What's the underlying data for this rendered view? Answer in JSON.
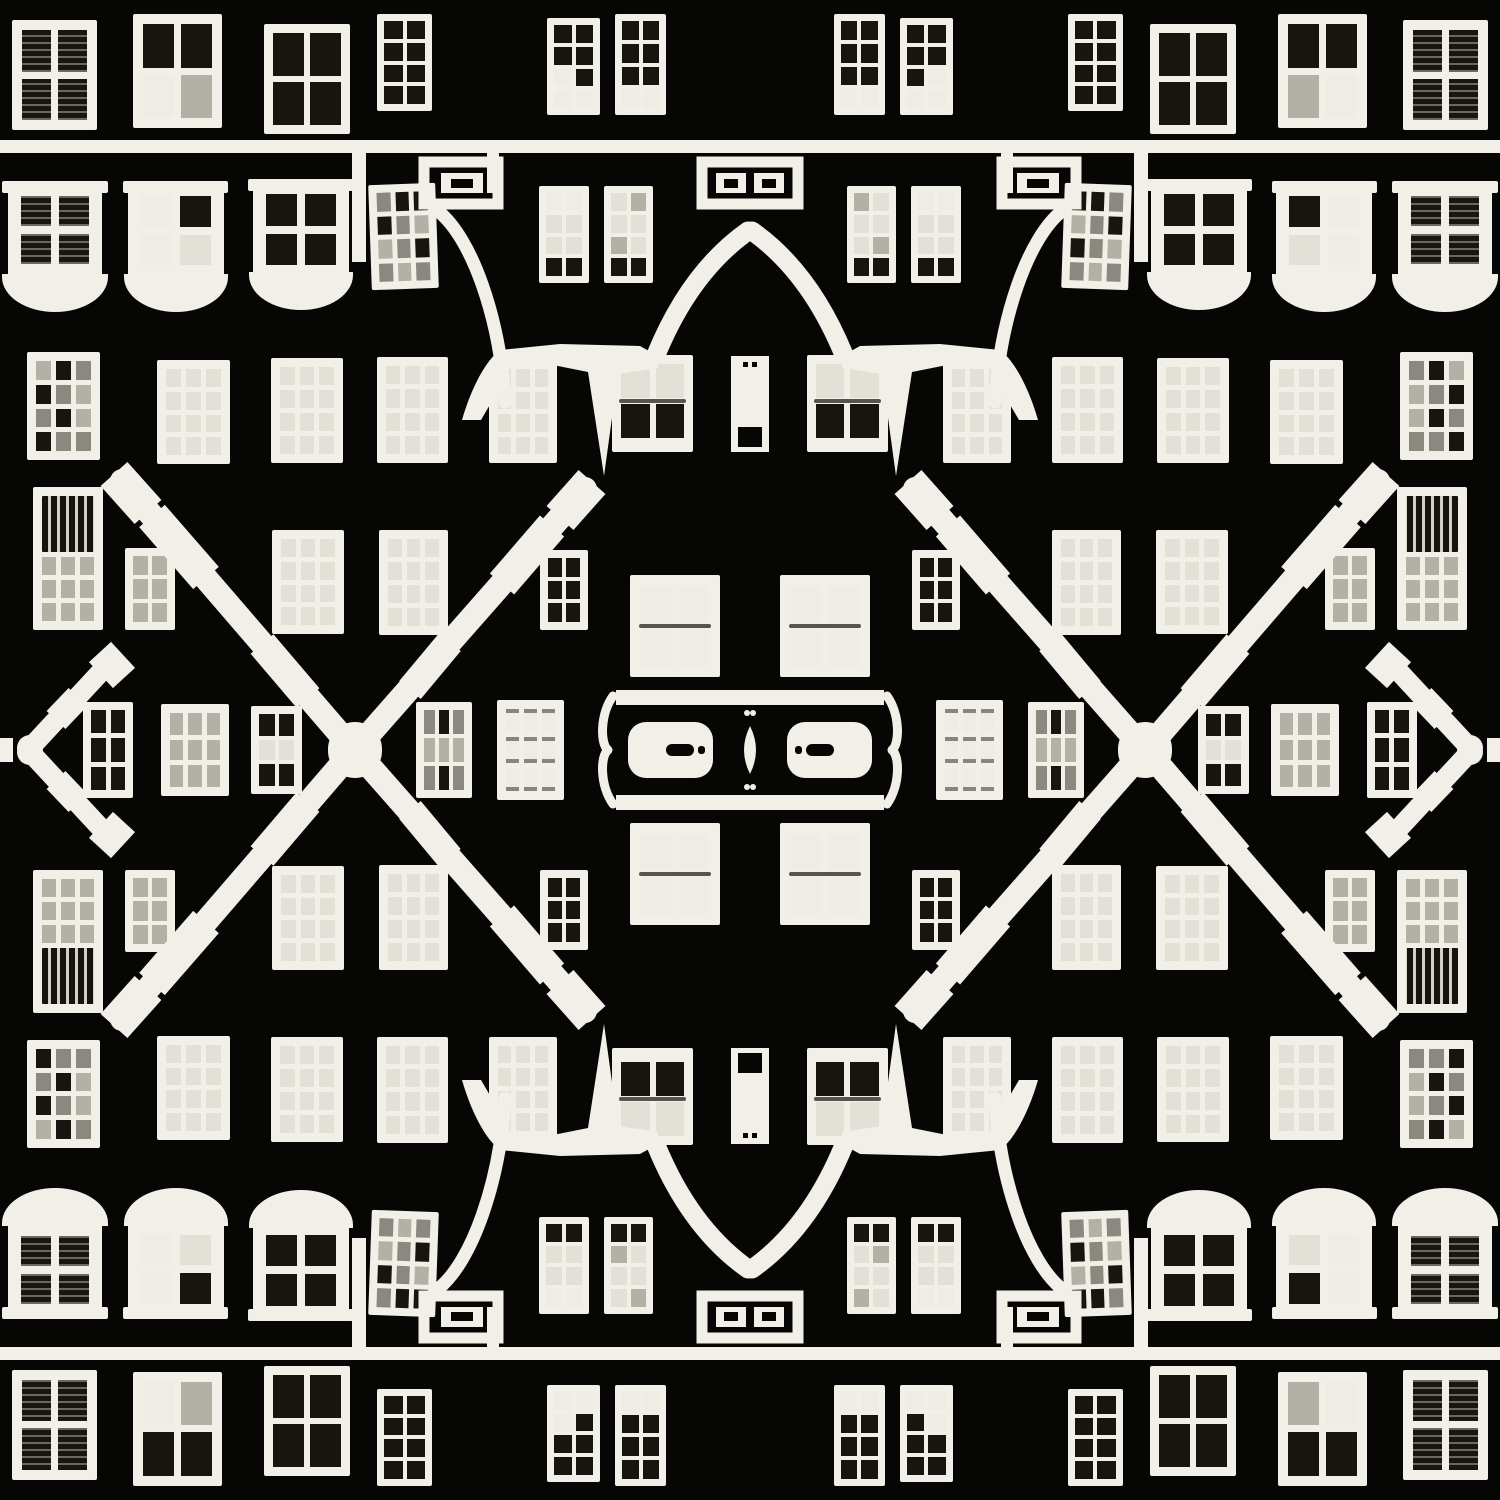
{
  "meta": {
    "title": "Kaleidoscopic facade",
    "alt": "Black-and-white kaleidoscopic photo collage of a building facade: a mirrored grid of white-framed windows on a black wall, with X-shaped decorative timber beams, arched doorway curves, meander ornaments, bay-window sills and a central door plaque. The image is symmetric left-right and top-bottom."
  },
  "palette": {
    "bg": "#060605",
    "white": "#f1efe8",
    "W": "#eeece4",
    "L": "#e3e0d7",
    "G": "#b3b0a6",
    "M": "#8b887f",
    "D": "#161510"
  },
  "quadrant": {
    "w": 750,
    "h": 750,
    "bars": [
      {
        "name": "bay-head-1",
        "x": 2,
        "y": 181,
        "w": 106,
        "h": 12
      },
      {
        "name": "bay-head-2",
        "x": 123,
        "y": 181,
        "w": 105,
        "h": 12
      },
      {
        "name": "bay-head-3",
        "x": 248,
        "y": 179,
        "w": 105,
        "h": 12
      }
    ],
    "bowls": [
      {
        "x": 2,
        "y": 274,
        "w": 106,
        "h": 38
      },
      {
        "x": 124,
        "y": 274,
        "w": 104,
        "h": 38
      },
      {
        "x": 249,
        "y": 272,
        "w": 104,
        "h": 38
      }
    ],
    "windows": [
      {
        "id": "a1",
        "x": 12,
        "y": 20,
        "w": 85,
        "h": 110,
        "f": 10,
        "g": 7,
        "cols": 2,
        "rows": 2,
        "fills": [
          "S",
          "S",
          "S",
          "S"
        ]
      },
      {
        "id": "a2",
        "x": 133,
        "y": 14,
        "w": 89,
        "h": 114,
        "f": 10,
        "g": 7,
        "cols": 2,
        "rows": 2,
        "fills": [
          "D",
          "D",
          "W",
          "G"
        ]
      },
      {
        "id": "a3",
        "x": 264,
        "y": 24,
        "w": 86,
        "h": 110,
        "f": 9,
        "g": 6,
        "cols": 2,
        "rows": 2,
        "fills": "D"
      },
      {
        "id": "a4",
        "x": 377,
        "y": 14,
        "w": 55,
        "h": 97,
        "f": 7,
        "g": 4,
        "cols": 2,
        "rows": 4,
        "fills": "D"
      },
      {
        "id": "a5",
        "x": 547,
        "y": 18,
        "w": 53,
        "h": 97,
        "f": 7,
        "g": 4,
        "cols": 2,
        "rows": 4,
        "fills": [
          "D",
          "D",
          "D",
          "D",
          "W",
          "D",
          "W",
          "W"
        ]
      },
      {
        "id": "a6",
        "x": 615,
        "y": 14,
        "w": 51,
        "h": 101,
        "f": 7,
        "g": 4,
        "cols": 2,
        "rows": 4,
        "fills": [
          "D",
          "D",
          "D",
          "D",
          "D",
          "D",
          "W",
          "W"
        ]
      },
      {
        "id": "b1",
        "x": 8,
        "y": 183,
        "w": 94,
        "h": 94,
        "f": 13,
        "g": 8,
        "cols": 2,
        "rows": 2,
        "fills": "S"
      },
      {
        "id": "b2",
        "x": 128,
        "y": 183,
        "w": 96,
        "h": 95,
        "f": 13,
        "g": 8,
        "cols": 2,
        "rows": 2,
        "fills": [
          "W",
          "D",
          "W",
          "L"
        ]
      },
      {
        "id": "b3",
        "x": 253,
        "y": 181,
        "w": 96,
        "h": 97,
        "f": 13,
        "g": 8,
        "cols": 2,
        "rows": 2,
        "fills": "D"
      },
      {
        "id": "b4",
        "x": 370,
        "y": 184,
        "w": 67,
        "h": 105,
        "f": 8,
        "g": 5,
        "cols": 3,
        "rows": 4,
        "fills": [
          "M",
          "D",
          "D",
          "D",
          "M",
          "G",
          "G",
          "M",
          "D",
          "M",
          "G",
          "M"
        ],
        "o": {
          "tilt": -2
        }
      },
      {
        "id": "b5",
        "x": 539,
        "y": 186,
        "w": 50,
        "h": 97,
        "f": 7,
        "g": 4,
        "cols": 2,
        "rows": 4,
        "fills": [
          "W",
          "W",
          "L",
          "L",
          "L",
          "L",
          "D",
          "D"
        ]
      },
      {
        "id": "b6",
        "x": 604,
        "y": 186,
        "w": 49,
        "h": 97,
        "f": 7,
        "g": 4,
        "cols": 2,
        "rows": 4,
        "fills": [
          "L",
          "G",
          "L",
          "L",
          "G",
          "L",
          "D",
          "D"
        ]
      },
      {
        "id": "c1",
        "x": 27,
        "y": 352,
        "w": 73,
        "h": 108,
        "f": 9,
        "g": 5,
        "cols": 3,
        "rows": 4,
        "fills": [
          "G",
          "D",
          "M",
          "D",
          "M",
          "G",
          "M",
          "D",
          "G",
          "D",
          "M",
          "M"
        ]
      },
      {
        "id": "c2",
        "x": 157,
        "y": 360,
        "w": 73,
        "h": 104,
        "f": 9,
        "g": 5,
        "cols": 3,
        "rows": 4,
        "fills": "L"
      },
      {
        "id": "c3",
        "x": 271,
        "y": 358,
        "w": 72,
        "h": 105,
        "f": 9,
        "g": 5,
        "cols": 3,
        "rows": 4,
        "fills": "L"
      },
      {
        "id": "c4",
        "x": 377,
        "y": 357,
        "w": 71,
        "h": 106,
        "f": 9,
        "g": 5,
        "cols": 3,
        "rows": 4,
        "fills": "L"
      },
      {
        "id": "c5",
        "x": 489,
        "y": 360,
        "w": 68,
        "h": 103,
        "f": 9,
        "g": 5,
        "cols": 3,
        "rows": 4,
        "fills": "L"
      },
      {
        "id": "c6",
        "x": 612,
        "y": 355,
        "w": 81,
        "h": 97,
        "f": 9,
        "g": 6,
        "cols": 2,
        "rows": 2,
        "fills": [
          "L",
          "L",
          "D",
          "D"
        ],
        "o": {
          "rail": 1,
          "sill": 5
        }
      },
      {
        "id": "d1",
        "x": 33,
        "y": 487,
        "w": 70,
        "h": 143,
        "f": 9,
        "g": 5,
        "cols": 3,
        "rows": 3,
        "fills": "G",
        "o": {
          "balusters": 56
        }
      },
      {
        "id": "d2",
        "x": 125,
        "y": 548,
        "w": 50,
        "h": 82,
        "f": 8,
        "g": 4,
        "cols": 2,
        "rows": 3,
        "fills": "G"
      },
      {
        "id": "d3",
        "x": 272,
        "y": 530,
        "w": 72,
        "h": 104,
        "f": 9,
        "g": 5,
        "cols": 3,
        "rows": 4,
        "fills": "L"
      },
      {
        "id": "d4",
        "x": 379,
        "y": 530,
        "w": 69,
        "h": 105,
        "f": 9,
        "g": 5,
        "cols": 3,
        "rows": 4,
        "fills": "L"
      },
      {
        "id": "d5",
        "x": 540,
        "y": 550,
        "w": 48,
        "h": 80,
        "f": 8,
        "g": 4,
        "cols": 2,
        "rows": 3,
        "fills": "D"
      },
      {
        "id": "e1",
        "x": 83,
        "y": 702,
        "w": 50,
        "h": 96,
        "f": 8,
        "g": 5,
        "cols": 2,
        "rows": 3,
        "fills": "D"
      },
      {
        "id": "e2",
        "x": 161,
        "y": 704,
        "w": 68,
        "h": 94,
        "f": 9,
        "g": 5,
        "cols": 3,
        "rows": 3,
        "fills": "G"
      },
      {
        "id": "e3",
        "x": 251,
        "y": 706,
        "w": 51,
        "h": 90,
        "f": 8,
        "g": 4,
        "cols": 2,
        "rows": 3,
        "fills": [
          "D",
          "D",
          "L",
          "L",
          "L",
          "L"
        ]
      },
      {
        "id": "e4",
        "x": 416,
        "y": 702,
        "w": 56,
        "h": 96,
        "f": 8,
        "g": 4,
        "cols": 3,
        "rows": 3,
        "fills": [
          "M",
          "D",
          "M",
          "G",
          "G",
          "G",
          "G",
          "M",
          "G"
        ]
      },
      {
        "id": "e5",
        "x": 497,
        "y": 700,
        "w": 67,
        "h": 98,
        "f": 9,
        "g": 5,
        "cols": 3,
        "rows": 3,
        "fills": "W",
        "o": {
          "tick": 1
        }
      },
      {
        "id": "center-sash",
        "x": 630,
        "y": 575,
        "w": 90,
        "h": 102,
        "f": 11,
        "g": 7,
        "cols": 2,
        "rows": 2,
        "fills": "W",
        "o": {
          "rail": 1
        }
      }
    ],
    "shapes": [
      {
        "t": "rect",
        "name": "ledge",
        "x": 0,
        "y": 140,
        "w": 750,
        "h": 13
      },
      {
        "t": "rect",
        "name": "ledge-post",
        "x": 352,
        "y": 146,
        "w": 14,
        "h": 116
      },
      {
        "t": "rect",
        "name": "ledge-post-2",
        "x": 487,
        "y": 140,
        "w": 12,
        "h": 53
      },
      {
        "t": "rect",
        "name": "meander-ornament-outer",
        "x": 424,
        "y": 162,
        "w": 74,
        "h": 42,
        "fill": "none",
        "sw": 11
      },
      {
        "t": "rect",
        "name": "meander-ornament-inner",
        "x": 441,
        "y": 173,
        "w": 42,
        "h": 20
      },
      {
        "t": "rect",
        "name": "meander-ornament-hole",
        "x": 451,
        "y": 179,
        "w": 22,
        "h": 9,
        "fill": "bg"
      },
      {
        "t": "rect",
        "name": "center-meander-outer",
        "x": 702,
        "y": 162,
        "w": 96,
        "h": 42,
        "fill": "none",
        "sw": 11
      },
      {
        "t": "rect",
        "name": "center-meander-inner",
        "x": 716,
        "y": 173,
        "w": 30,
        "h": 20
      },
      {
        "t": "rect",
        "name": "center-meander-hole",
        "x": 724,
        "y": 179,
        "w": 14,
        "h": 9,
        "fill": "bg"
      },
      {
        "t": "path",
        "name": "doorway-arc",
        "d": "M438,211 C472,238 500,318 505,402",
        "fill": "none",
        "sw": 13
      },
      {
        "t": "path",
        "name": "gothic-arch",
        "d": "M656,355 Q690,272 748,231",
        "fill": "none",
        "sw": 19
      },
      {
        "t": "path",
        "name": "porch-mass",
        "d": "M462,420 C470,392 484,362 500,350 L560,344 L640,346 L658,356 L658,368 L618,374 L604,476 L588,372 L548,364 L510,366 L495,396 L481,420 Z"
      },
      {
        "t": "rect",
        "name": "door",
        "x": 731,
        "y": 356,
        "w": 19,
        "h": 96
      },
      {
        "t": "rect",
        "name": "door-panel",
        "x": 738,
        "y": 427,
        "w": 12,
        "h": 20,
        "fill": "bg"
      },
      {
        "t": "rect",
        "name": "door-mark",
        "x": 743,
        "y": 362,
        "w": 5,
        "h": 5,
        "fill": "bg"
      },
      {
        "t": "rect",
        "name": "plaque-top-bar",
        "x": 616,
        "y": 690,
        "w": 134,
        "h": 15
      },
      {
        "t": "path",
        "name": "plaque-bracket",
        "d": "M613,696 C600,714 600,744 608,750",
        "fill": "none",
        "sw": 9
      },
      {
        "t": "rect",
        "name": "plaque-panel",
        "x": 628,
        "y": 722,
        "w": 85,
        "h": 56,
        "rx": 18
      },
      {
        "t": "rect",
        "name": "plaque-handle",
        "x": 666,
        "y": 744,
        "w": 28,
        "h": 12,
        "rx": 6,
        "fill": "bg"
      },
      {
        "t": "rect",
        "name": "plaque-handle-dot",
        "x": 698,
        "y": 746,
        "w": 7,
        "h": 8,
        "rx": 3,
        "fill": "bg"
      },
      {
        "t": "path",
        "name": "center-finial",
        "d": "M750,726 Q738,750 750,774 Z"
      },
      {
        "t": "circle",
        "name": "center-finial-dot",
        "cx": 747,
        "cy": 713,
        "r": 3
      },
      {
        "t": "line",
        "name": "cross-beam-left",
        "x1": 122,
        "y1": 481,
        "x2": 352,
        "y2": 748,
        "sw": 24
      },
      {
        "t": "line",
        "name": "beam-left-foot",
        "x1": 114,
        "y1": 474,
        "x2": 148,
        "y2": 512,
        "sw": 36,
        "cap": "butt"
      },
      {
        "t": "line",
        "name": "beam-left-molding",
        "x1": 152,
        "y1": 516,
        "x2": 206,
        "y2": 578,
        "sw": 34,
        "cap": "butt"
      },
      {
        "t": "line",
        "name": "beam-left-molding-2",
        "x1": 262,
        "y1": 644,
        "x2": 308,
        "y2": 698,
        "sw": 30,
        "cap": "butt"
      },
      {
        "t": "line",
        "name": "cross-beam-right",
        "x1": 585,
        "y1": 489,
        "x2": 357,
        "y2": 748,
        "sw": 24
      },
      {
        "t": "line",
        "name": "beam-right-foot",
        "x1": 592,
        "y1": 482,
        "x2": 560,
        "y2": 518,
        "sw": 36,
        "cap": "butt"
      },
      {
        "t": "line",
        "name": "beam-right-molding",
        "x1": 552,
        "y1": 526,
        "x2": 502,
        "y2": 584,
        "sw": 32,
        "cap": "butt"
      },
      {
        "t": "line",
        "name": "beam-right-molding-2",
        "x1": 450,
        "y1": 642,
        "x2": 410,
        "y2": 690,
        "sw": 28,
        "cap": "butt"
      },
      {
        "t": "circle",
        "name": "beam-cross-node",
        "cx": 355,
        "cy": 749,
        "r": 27
      },
      {
        "t": "line",
        "name": "edge-bracket-arm",
        "x1": 32,
        "y1": 746,
        "x2": 110,
        "y2": 662,
        "sw": 20
      },
      {
        "t": "line",
        "name": "edge-bracket-foot",
        "x1": 100,
        "y1": 652,
        "x2": 124,
        "y2": 678,
        "sw": 30,
        "cap": "butt"
      },
      {
        "t": "line",
        "name": "edge-bracket-molding",
        "x1": 56,
        "y1": 720,
        "x2": 78,
        "y2": 697,
        "sw": 26,
        "cap": "butt"
      },
      {
        "t": "circle",
        "name": "edge-bracket-tip",
        "cx": 30,
        "cy": 748,
        "r": 13
      },
      {
        "t": "rect",
        "name": "edge-stub",
        "x": 0,
        "y": 738,
        "w": 13,
        "h": 12
      }
    ]
  }
}
